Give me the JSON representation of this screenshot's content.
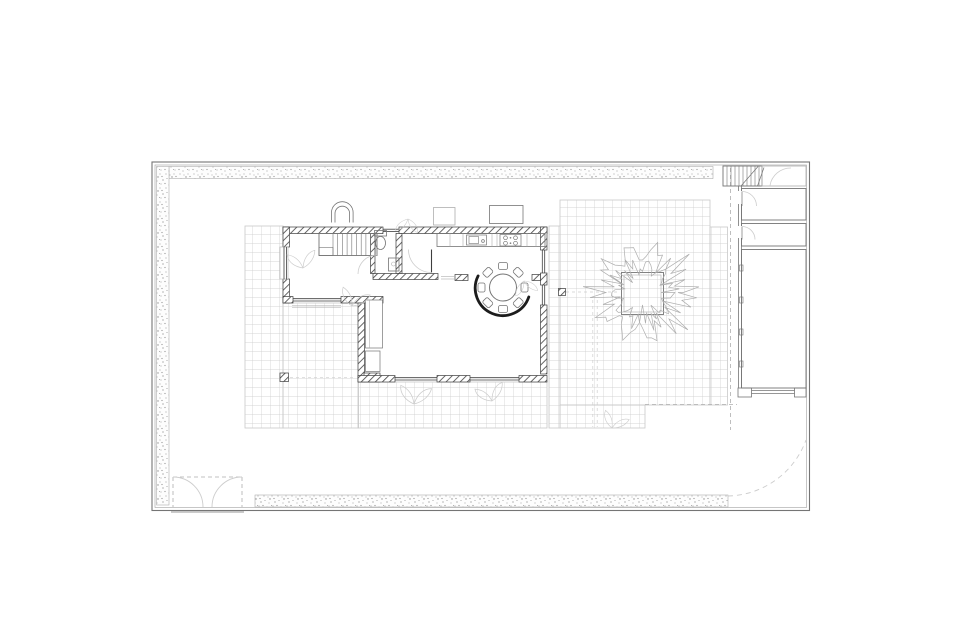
{
  "plan": {
    "type": "architectural-floor-plan",
    "view": "site plan of a walled garden house with paved terrace",
    "elements": [
      "perimeter-wall",
      "hedge-border-top",
      "hedge-border-left",
      "hedge-border-bottom",
      "paved-terrace-grid",
      "main-house",
      "hatched-masonry-walls",
      "entry-arch",
      "interior-stair",
      "wc-toilet",
      "wc-basin",
      "kitchen-counter",
      "kitchen-sink",
      "cooktop",
      "round-dining-table",
      "dining-chairs",
      "curved-partition-wall",
      "wardrobe-closets",
      "structural-columns",
      "window-glazing",
      "tree",
      "square-tree-planter",
      "service-wing",
      "service-stair",
      "service-room-upper",
      "service-room-lower",
      "garage",
      "garden-double-gate",
      "driveway-gate-swing",
      "module-dashed-lines",
      "shrub-sketches"
    ],
    "counts": {
      "dining_chairs": 8,
      "service_rooms": 3,
      "gates": 2,
      "trees": 1
    }
  },
  "palette": {
    "paper": "#ffffff",
    "line-dark": "#3e3e3e",
    "line-med": "#757575",
    "line-light": "#aeaeae",
    "line-ghost": "#cdcdcd",
    "hatch": "#4a4a4a",
    "grid": "#c9c9c9",
    "stipple": "#8f8f8f",
    "arc-accent": "#1c1c1c"
  }
}
